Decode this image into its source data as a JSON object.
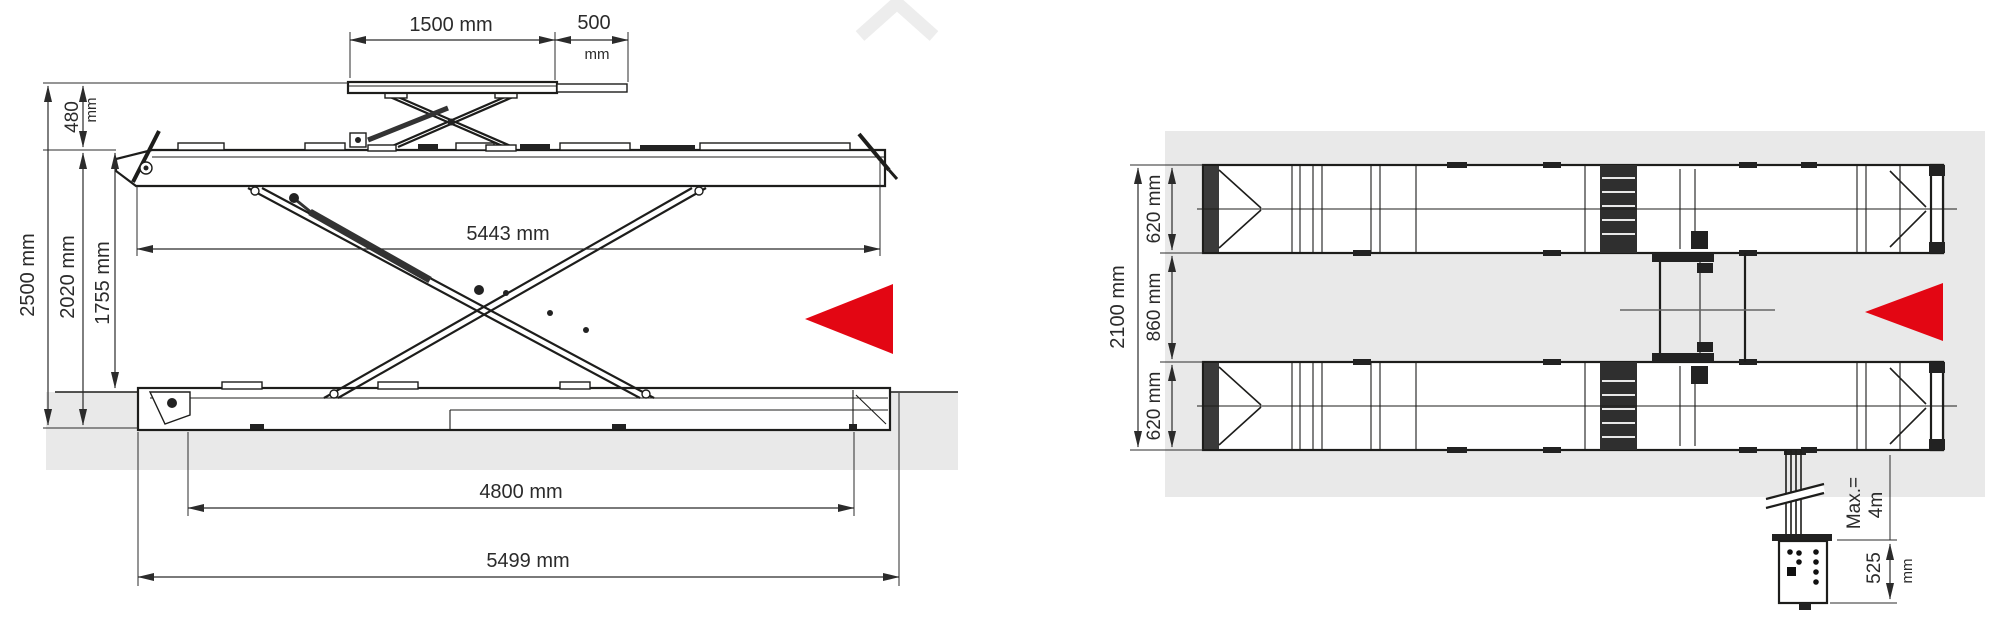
{
  "colors": {
    "accent_red": "#e30613",
    "ground_gray": "#e9e9e9",
    "line_dark": "#1d1d1b"
  },
  "icons": {
    "direction_arrow": "red-triangle-pointing-left",
    "watermark": "light-gray-chevron"
  },
  "side_view": {
    "dims": {
      "jack_platform_length": "1500 mm",
      "jack_extension_value": "500",
      "jack_extension_unit": "mm",
      "jack_height_value": "480",
      "jack_height_unit": "mm",
      "overall_height": "2500 mm",
      "runway_top_height": "2020 mm",
      "underbody_clearance": "1755 mm",
      "runway_length": "5443 mm",
      "base_length": "4800 mm",
      "overall_length": "5499 mm"
    }
  },
  "plan_view": {
    "dims": {
      "overall_width": "2100 mm",
      "runway_width_top": "620 mm",
      "track_gap": "860 mm",
      "runway_width_bottom": "620 mm",
      "cable_max_line1": "Max.=",
      "cable_max_line2": "4m",
      "console_offset_value": "525",
      "console_offset_unit": "mm"
    }
  }
}
